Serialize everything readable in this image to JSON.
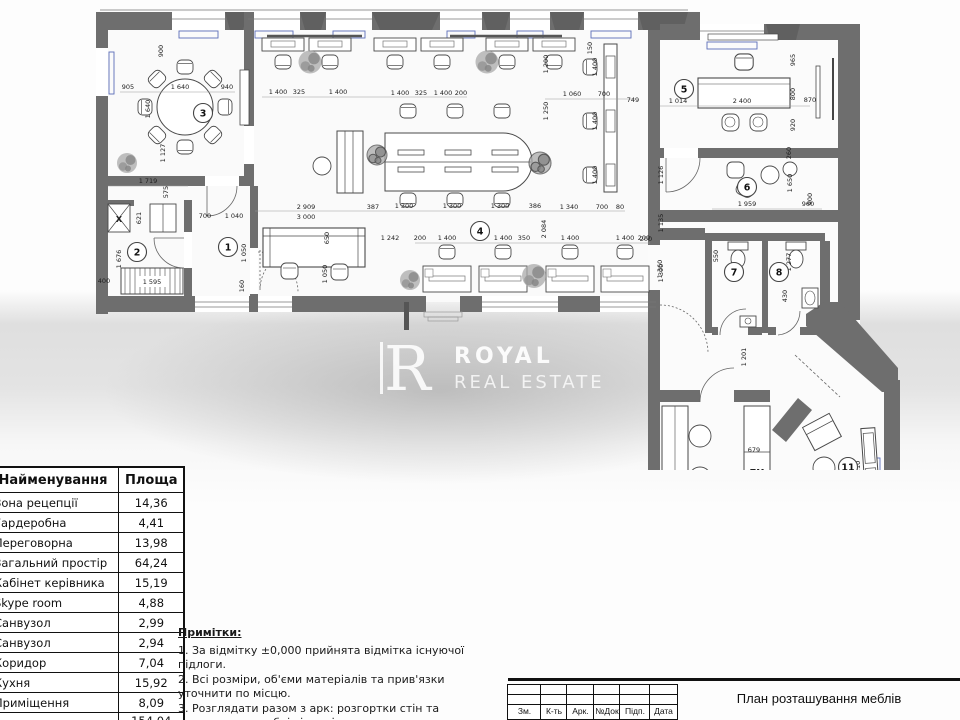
{
  "watermark": {
    "logo_letter": "R",
    "brand_line1": "ROYAL",
    "brand_line2": "REAL ESTATE"
  },
  "area_table": {
    "headers": [
      "Найменування",
      "Площа"
    ],
    "rows": [
      [
        "Зона рецепції",
        "14,36"
      ],
      [
        "Гардеробна",
        "4,41"
      ],
      [
        "Переговорна",
        "13,98"
      ],
      [
        "Загальний простір",
        "64,24"
      ],
      [
        "Кабінет керівника",
        "15,19"
      ],
      [
        "Skype room",
        "4,88"
      ],
      [
        "Санвузол",
        "2,99"
      ],
      [
        "Санвузол",
        "2,94"
      ],
      [
        "Коридор",
        "7,04"
      ],
      [
        "Кухня",
        "15,92"
      ],
      [
        "Приміщення",
        "8,09"
      ]
    ],
    "total": "154,04 м²"
  },
  "notes": {
    "title": "Примітки:",
    "items": [
      "1. За відмітку ±0,000 прийнята відмітка існуючої підлоги.",
      "2. Всі розміри, об'єми матеріалів та прив'язки уточнити по місцю.",
      "3. Розглядати разом з арк: розгортки стін та кресленнями меблів індивідуального виготовлення"
    ]
  },
  "title_block": {
    "columns": [
      "Зм.",
      "К-ть",
      "Арк.",
      "№Док",
      "Підп.",
      "Дата"
    ],
    "title": "План розташування меблів"
  },
  "plan": {
    "colors": {
      "wall": "#6e6e6e",
      "pier": "#626262",
      "line": "#4a4a4a",
      "accent_blue": "#5b6db8"
    },
    "room_badges": [
      {
        "x": 228,
        "y": 247,
        "label": "1"
      },
      {
        "x": 137,
        "y": 252,
        "label": "2"
      },
      {
        "x": 203,
        "y": 113,
        "label": "3"
      },
      {
        "x": 480,
        "y": 231,
        "label": "4"
      },
      {
        "x": 684,
        "y": 89,
        "label": "5"
      },
      {
        "x": 747,
        "y": 187,
        "label": "6"
      },
      {
        "x": 734,
        "y": 272,
        "label": "7"
      },
      {
        "x": 779,
        "y": 272,
        "label": "8"
      },
      {
        "x": 722,
        "y": 494,
        "label": "10"
      },
      {
        "x": 848,
        "y": 467,
        "label": "11"
      }
    ],
    "labels": [
      {
        "x": 757,
        "y": 475,
        "t": "ПМ"
      },
      {
        "x": 758,
        "y": 569,
        "t": "X"
      },
      {
        "x": 119,
        "y": 222,
        "t": "X"
      }
    ],
    "dimensions": [
      {
        "x": 163,
        "y": 51,
        "t": "900",
        "r": 1
      },
      {
        "x": 128,
        "y": 89,
        "t": "905",
        "r": 0
      },
      {
        "x": 180,
        "y": 89,
        "t": "1 640",
        "r": 0
      },
      {
        "x": 227,
        "y": 89,
        "t": "940",
        "r": 0
      },
      {
        "x": 150,
        "y": 109,
        "t": "1 640",
        "r": 1
      },
      {
        "x": 165,
        "y": 153,
        "t": "1 127",
        "r": 1
      },
      {
        "x": 148,
        "y": 183,
        "t": "1 719",
        "r": 0
      },
      {
        "x": 168,
        "y": 192,
        "t": "575",
        "r": 1
      },
      {
        "x": 141,
        "y": 218,
        "t": "621",
        "r": 1
      },
      {
        "x": 205,
        "y": 218,
        "t": "700",
        "r": 0
      },
      {
        "x": 234,
        "y": 218,
        "t": "1 040",
        "r": 0
      },
      {
        "x": 121,
        "y": 259,
        "t": "1 676",
        "r": 1
      },
      {
        "x": 104,
        "y": 283,
        "t": "400",
        "r": 0
      },
      {
        "x": 152,
        "y": 284,
        "t": "1 595",
        "r": 0
      },
      {
        "x": 246,
        "y": 253,
        "t": "1 050",
        "r": 1
      },
      {
        "x": 306,
        "y": 209,
        "t": "2 909",
        "r": 0
      },
      {
        "x": 306,
        "y": 219,
        "t": "3 000",
        "r": 0
      },
      {
        "x": 373,
        "y": 209,
        "t": "387",
        "r": 0
      },
      {
        "x": 329,
        "y": 238,
        "t": "650",
        "r": 1
      },
      {
        "x": 327,
        "y": 274,
        "t": "1 050",
        "r": 1
      },
      {
        "x": 244,
        "y": 286,
        "t": "160",
        "r": 1
      },
      {
        "x": 278,
        "y": 94,
        "t": "1 400",
        "r": 0
      },
      {
        "x": 299,
        "y": 94,
        "t": "325",
        "r": 0
      },
      {
        "x": 338,
        "y": 94,
        "t": "1 400",
        "r": 0
      },
      {
        "x": 400,
        "y": 95,
        "t": "1 400",
        "r": 0
      },
      {
        "x": 421,
        "y": 95,
        "t": "325",
        "r": 0
      },
      {
        "x": 443,
        "y": 95,
        "t": "1 400",
        "r": 0
      },
      {
        "x": 461,
        "y": 95,
        "t": "200",
        "r": 0
      },
      {
        "x": 572,
        "y": 96,
        "t": "1 060",
        "r": 0
      },
      {
        "x": 604,
        "y": 96,
        "t": "700",
        "r": 0
      },
      {
        "x": 633,
        "y": 102,
        "t": "749",
        "r": 0
      },
      {
        "x": 548,
        "y": 64,
        "t": "1 200",
        "r": 1
      },
      {
        "x": 548,
        "y": 111,
        "t": "1 250",
        "r": 1
      },
      {
        "x": 592,
        "y": 48,
        "t": "150",
        "r": 1
      },
      {
        "x": 597,
        "y": 67,
        "t": "1 400",
        "r": 1
      },
      {
        "x": 597,
        "y": 121,
        "t": "1 400",
        "r": 1
      },
      {
        "x": 597,
        "y": 175,
        "t": "1 400",
        "r": 1
      },
      {
        "x": 404,
        "y": 208,
        "t": "1 300",
        "r": 0
      },
      {
        "x": 452,
        "y": 208,
        "t": "1 300",
        "r": 0
      },
      {
        "x": 500,
        "y": 208,
        "t": "1 300",
        "r": 0
      },
      {
        "x": 535,
        "y": 208,
        "t": "386",
        "r": 0
      },
      {
        "x": 569,
        "y": 209,
        "t": "1 340",
        "r": 0
      },
      {
        "x": 602,
        "y": 209,
        "t": "700",
        "r": 0
      },
      {
        "x": 620,
        "y": 209,
        "t": "80",
        "r": 0
      },
      {
        "x": 390,
        "y": 240,
        "t": "1 242",
        "r": 0
      },
      {
        "x": 420,
        "y": 240,
        "t": "200",
        "r": 0
      },
      {
        "x": 447,
        "y": 240,
        "t": "1 400",
        "r": 0
      },
      {
        "x": 503,
        "y": 240,
        "t": "1 400",
        "r": 0
      },
      {
        "x": 524,
        "y": 240,
        "t": "350",
        "r": 0
      },
      {
        "x": 570,
        "y": 240,
        "t": "1 400",
        "r": 0
      },
      {
        "x": 625,
        "y": 240,
        "t": "1 400",
        "r": 0
      },
      {
        "x": 644,
        "y": 240,
        "t": "200",
        "r": 0
      },
      {
        "x": 546,
        "y": 229,
        "t": "2 084",
        "r": 1
      },
      {
        "x": 663,
        "y": 223,
        "t": "1 135",
        "r": 1
      },
      {
        "x": 663,
        "y": 273,
        "t": "1 300",
        "r": 1
      },
      {
        "x": 678,
        "y": 103,
        "t": "1 014",
        "r": 0
      },
      {
        "x": 742,
        "y": 103,
        "t": "2 400",
        "r": 0
      },
      {
        "x": 795,
        "y": 60,
        "t": "965",
        "r": 1
      },
      {
        "x": 795,
        "y": 94,
        "t": "800",
        "r": 1
      },
      {
        "x": 810,
        "y": 102,
        "t": "870",
        "r": 0
      },
      {
        "x": 795,
        "y": 125,
        "t": "920",
        "r": 1
      },
      {
        "x": 791,
        "y": 153,
        "t": "260",
        "r": 1
      },
      {
        "x": 812,
        "y": 199,
        "t": "900",
        "r": 1
      },
      {
        "x": 663,
        "y": 175,
        "t": "1 126",
        "r": 1
      },
      {
        "x": 747,
        "y": 206,
        "t": "1 959",
        "r": 0
      },
      {
        "x": 808,
        "y": 206,
        "t": "960",
        "r": 0
      },
      {
        "x": 792,
        "y": 183,
        "t": "1 650",
        "r": 1
      },
      {
        "x": 646,
        "y": 241,
        "t": "200",
        "r": 0
      },
      {
        "x": 662,
        "y": 269,
        "t": "1 360",
        "r": 1
      },
      {
        "x": 718,
        "y": 256,
        "t": "550",
        "r": 1
      },
      {
        "x": 791,
        "y": 262,
        "t": "1 277",
        "r": 1
      },
      {
        "x": 787,
        "y": 296,
        "t": "430",
        "r": 1
      },
      {
        "x": 746,
        "y": 357,
        "t": "1 201",
        "r": 1
      },
      {
        "x": 671,
        "y": 497,
        "t": "5 160",
        "r": 1
      },
      {
        "x": 736,
        "y": 495,
        "t": "3 600",
        "r": 1
      },
      {
        "x": 754,
        "y": 452,
        "t": "679",
        "r": 0
      },
      {
        "x": 752,
        "y": 532,
        "t": "600",
        "r": 0
      },
      {
        "x": 733,
        "y": 589,
        "t": "750",
        "r": 1
      },
      {
        "x": 860,
        "y": 470,
        "t": "4 110",
        "r": 1
      }
    ]
  }
}
